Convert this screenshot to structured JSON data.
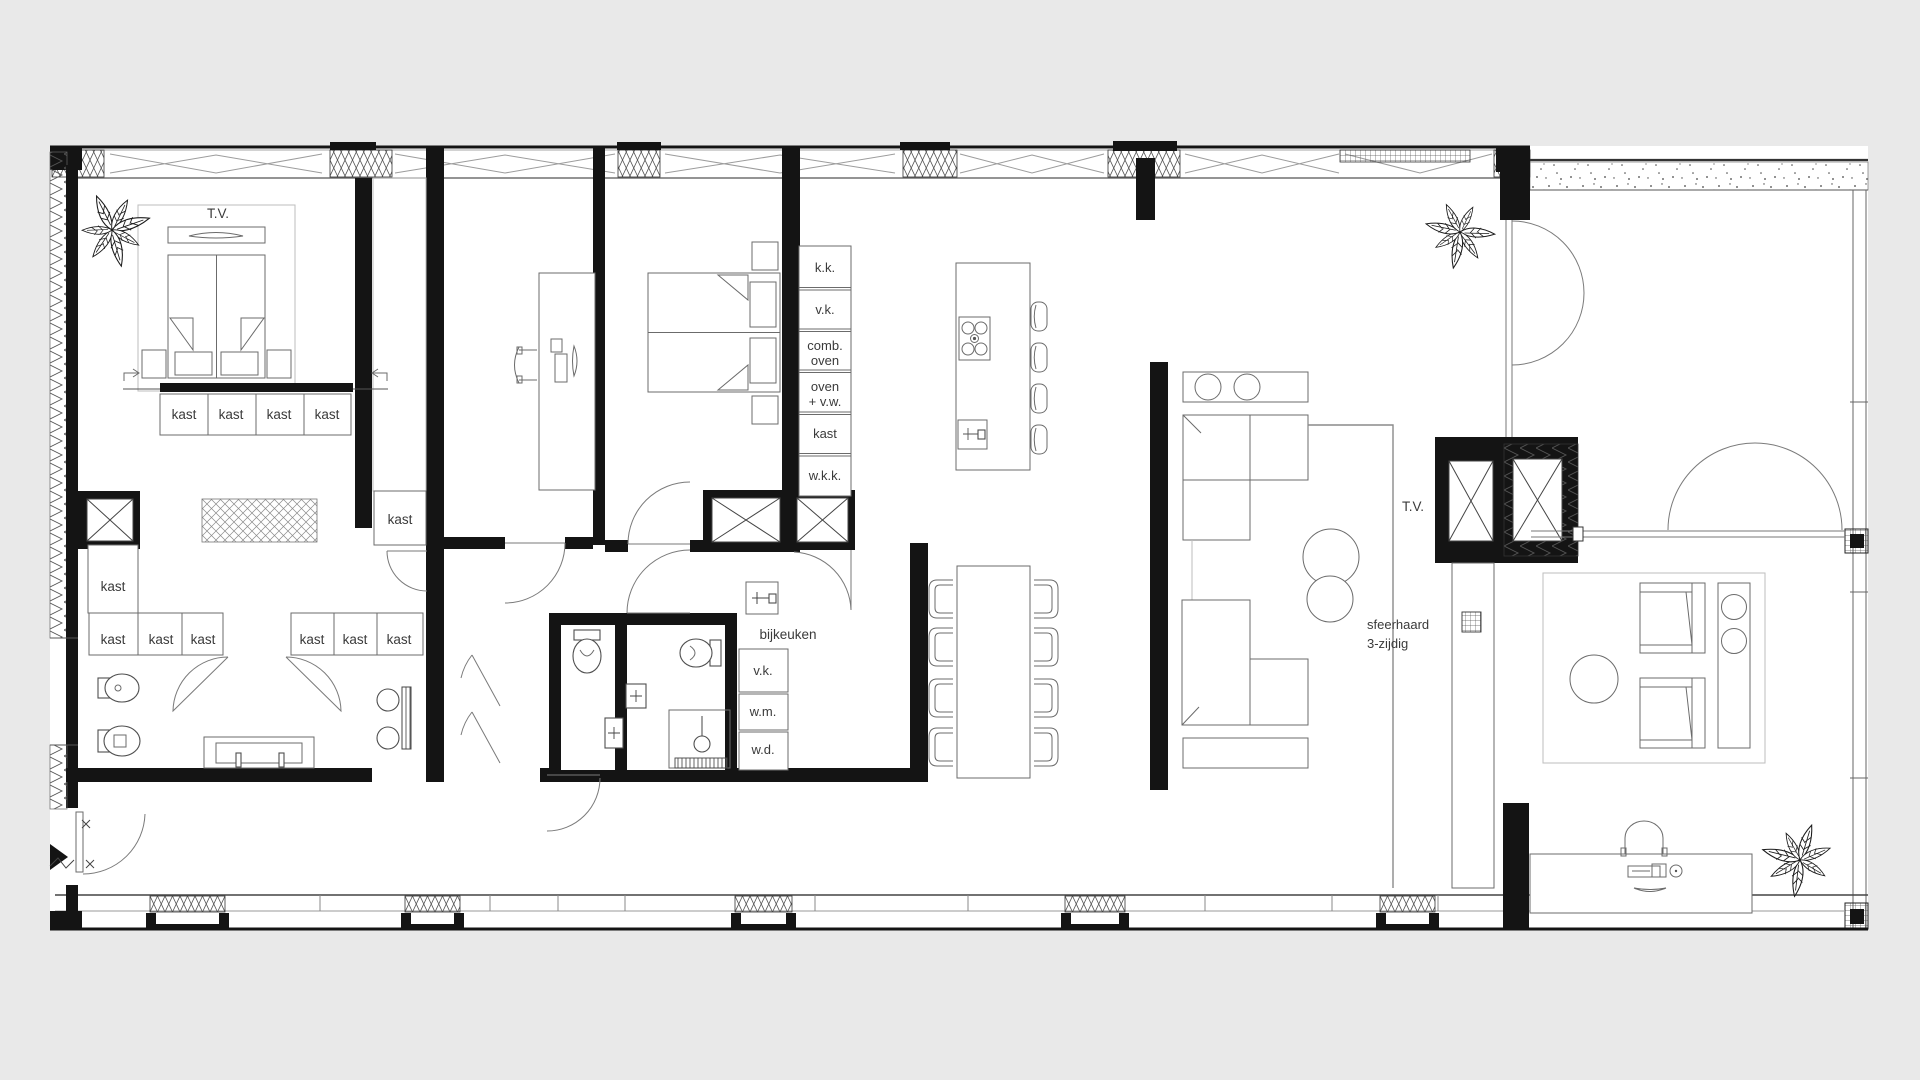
{
  "document_type": "architectural-floor-plan",
  "colors": {
    "background": "#e9e9e9",
    "paper": "#ffffff",
    "wall": "#141414",
    "furniture_line": "#6b6b6b",
    "text": "#3a3a3a"
  },
  "icons": {
    "plant": "potted-plant-icon",
    "shaft": "shaft-cross-icon",
    "door": "door-swing-arc-icon",
    "entry": "entry-arrow-icon"
  },
  "labels": {
    "tv_master": "T.V.",
    "tv_living": "T.V.",
    "kast": "kast",
    "kk": "k.k.",
    "vk": "v.k.",
    "comb1": "comb.",
    "comb2": "oven",
    "ovw1": "oven",
    "ovw2": "+ v.w.",
    "wkk": "w.k.k.",
    "bijkeuken": "bijkeuken",
    "vk2": "v.k.",
    "wm": "w.m.",
    "wd": "w.d.",
    "sf1": "sfeerhaard",
    "sf2": "3-zijdig"
  }
}
